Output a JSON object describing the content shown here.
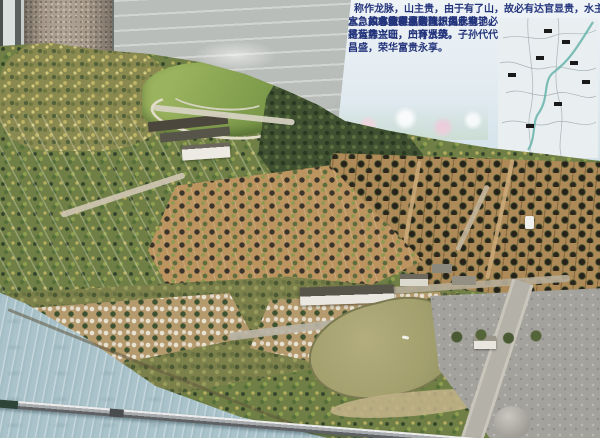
{
  "photo": {
    "caption": "Photograph of a physical scale model of a feng shui cemetery hillside: terraced slopes covered with miniature trees, rows of tomb mounds and white grave markers, a main hall building, a pond, a pale-blue river along the front edge, a gray plaza, and a long metal pointer resting on the model; an explanatory Chinese sign stands at the upper right"
  },
  "sign": {
    "line1": "称作龙脉，山主贵，由于有了山，故必有达官显贵，水主财",
    "line2": "宜急，才能得水聚气，由于有了",
    "line3": "水，故必使家业兴隆。",
    "para2": "风水家眼里的理想风水宝地，是背靠主山，山环水绕。",
    "para3": "如有缘有福者，识得此地，必将运势兴旺，产育贤英，子孙代代昌盛，荣华富贵永享。"
  },
  "palette": {
    "sign_text": "#24357c",
    "sign_bg": "#eef3f6",
    "river": "#aac3cb",
    "pond": "#a3a06e",
    "plaza": "#a3a29d",
    "hill_green": "#6f7f45",
    "forest_dark": "#3f5130",
    "terrace_tan": "#ad8a57",
    "pillar": "#a6998a",
    "wall": "#b9bdb9"
  }
}
